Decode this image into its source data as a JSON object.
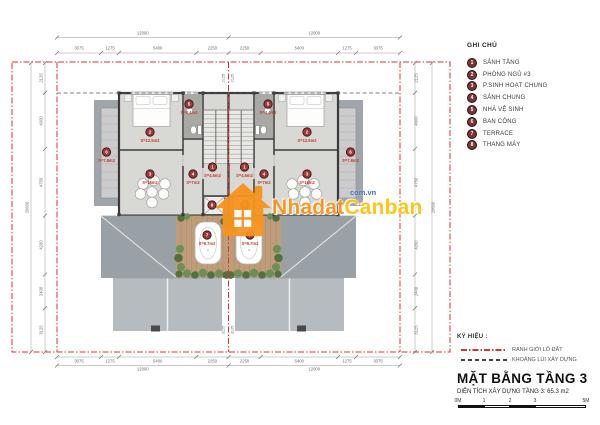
{
  "plan": {
    "dims": {
      "top_overall": [
        "12000",
        "12000"
      ],
      "segments_h": [
        "3075",
        "1275",
        "5400",
        "2250",
        "2250",
        "5400",
        "1275",
        "3075"
      ],
      "bottom_overall": [
        "12000",
        "12000"
      ],
      "segments_v": [
        "2125",
        "4000",
        "4750",
        "4200",
        "2400",
        "3125"
      ],
      "overall_v": "20600",
      "center_top": "2125",
      "center_bottom": "3125"
    },
    "rooms": [
      {
        "num": "1",
        "area": "S=4.6m2"
      },
      {
        "num": "2",
        "area": "S=12.5m2"
      },
      {
        "num": "3",
        "area": "S=16m2"
      },
      {
        "num": "4",
        "area": "S=7m2"
      },
      {
        "num": "5",
        "area": "S=4.4m2"
      },
      {
        "num": "6",
        "area": "S=7.8m2"
      },
      {
        "num": "7",
        "area": "S=9.7m2"
      },
      {
        "num": "8",
        "area": ""
      }
    ]
  },
  "watermark": {
    "name_part1": "Nhadat",
    "name_part2": "Canban",
    "domain": "com.vn"
  },
  "legend": {
    "title": "GHI CHÚ",
    "items": [
      {
        "num": "1",
        "label": "SẢNH TẦNG"
      },
      {
        "num": "2",
        "label": "PHÒNG NGỦ #3"
      },
      {
        "num": "3",
        "label": "P.SINH HOẠT CHUNG"
      },
      {
        "num": "4",
        "label": "SẢNH CHUNG"
      },
      {
        "num": "5",
        "label": "NHÀ VỆ SINH"
      },
      {
        "num": "6",
        "label": "BAN CÔNG"
      },
      {
        "num": "7",
        "label": "TERRACE"
      },
      {
        "num": "8",
        "label": "THANG MÁY"
      }
    ]
  },
  "title_block": {
    "symbols_heading": "KÝ HIỆU :",
    "symbols": [
      {
        "label": "RANH GIỚI LÔ ĐẤT"
      },
      {
        "label": "KHOẢNG LÙI XÂY DỰNG"
      }
    ],
    "title": "MẶT BẰNG TẦNG 3",
    "subtitle": "DIỆN TÍCH XÂY DỰNG TẦNG 3: 65.3 m2",
    "scale_labels": [
      "0M",
      "1",
      "2",
      "3",
      "5M"
    ]
  },
  "colors": {
    "lot_boundary_red": "#e03131",
    "room_marker_red": "#a23737",
    "area_text_red": "#c0392b",
    "watermark_orange": "#f7941d",
    "watermark_yellow": "#ffc20e",
    "watermark_blue": "#2e6db4",
    "roof_gray": "#9aa1a6",
    "terrace_wood": "#bf9d7b",
    "wall_dark": "#3a3a3a"
  }
}
